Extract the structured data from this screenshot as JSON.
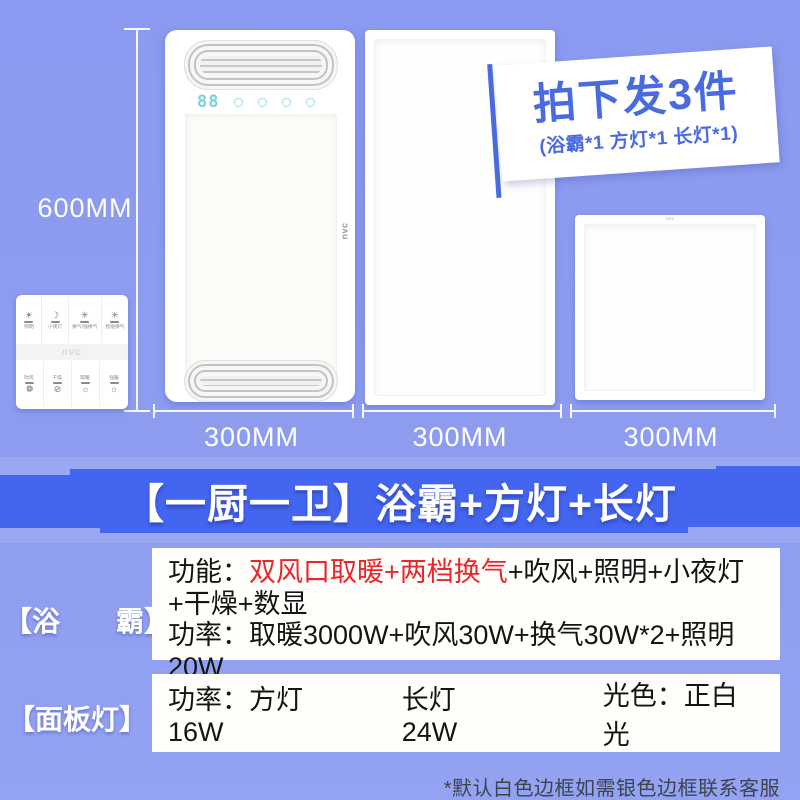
{
  "badge": {
    "title": "拍下发3件",
    "subtitle": "(浴霸*1 方灯*1 长灯*1)"
  },
  "showcase": {
    "height_label": "600MM",
    "width_labels": [
      "300MM",
      "300MM",
      "300MM"
    ],
    "heater_display": "88",
    "heater_brand": "nvc",
    "square_light_brand": "nvc"
  },
  "remote": {
    "brand": "nvc",
    "buttons": [
      {
        "icon": "light-icon",
        "glyph": "☀",
        "label": "照明"
      },
      {
        "icon": "night-light-icon",
        "glyph": "☽",
        "label": "小夜灯"
      },
      {
        "icon": "vent-icon",
        "glyph": "✳",
        "label": "换气/强换气"
      },
      {
        "icon": "smart-vent-icon",
        "glyph": "✳",
        "label": "智能换气"
      },
      {
        "icon": "blow-icon",
        "glyph": "❁",
        "label": "吹风"
      },
      {
        "icon": "dry-icon",
        "glyph": "⊘",
        "label": "干燥"
      },
      {
        "icon": "heat-icon",
        "glyph": "☼",
        "label": "取暖"
      },
      {
        "icon": "strong-heat-icon",
        "glyph": "☼",
        "label": "强暖"
      }
    ]
  },
  "banner": {
    "title": "【一厨一卫】浴霸+方灯+长灯"
  },
  "spec": {
    "row1": {
      "label": "【浴　　霸】",
      "line1_key": "功能：",
      "line1_highlight": "双风口取暖+两档换气",
      "line1_rest": "+吹风+照明+小夜灯",
      "line2": "+干燥+数显",
      "line3": "功率：取暖3000W+吹风30W+换气30W*2+照明20W"
    },
    "row2": {
      "label": "【面板灯】",
      "seg1": "功率：方灯16W",
      "seg2": "长灯24W",
      "seg3": "光色：正白光"
    }
  },
  "footer_note": "*默认白色边框如需银色边框联系客服",
  "colors": {
    "background": "#8b9af0",
    "ribbon": "#4365ef",
    "badge_text": "#4a6ae0",
    "highlight_red": "#e8262c",
    "display_cyan": "#74d5d8"
  }
}
